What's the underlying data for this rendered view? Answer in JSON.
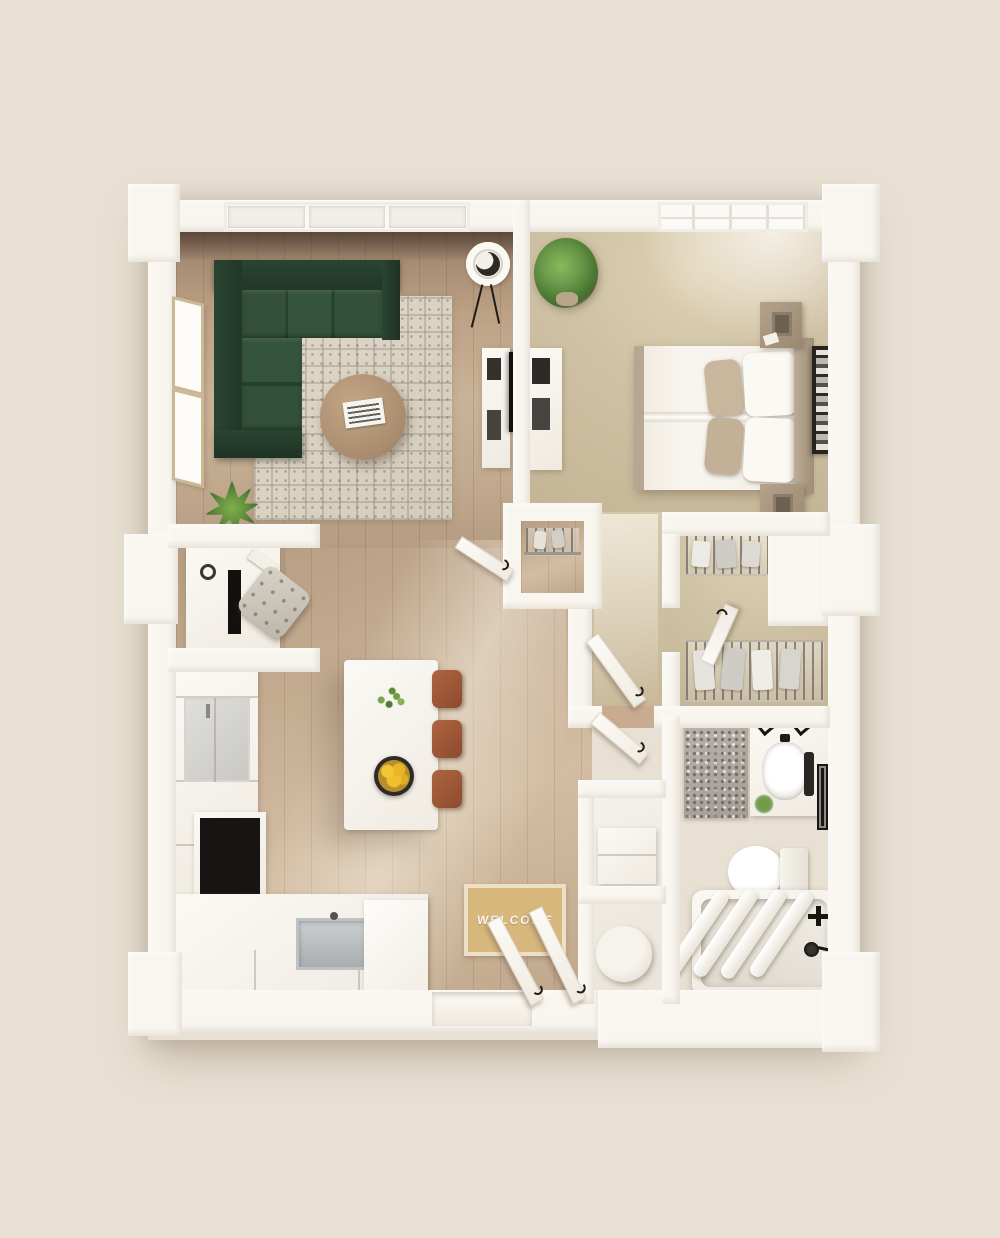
{
  "scene": {
    "title": "3D apartment floor plan, top-down dollhouse view",
    "view": "top-down"
  },
  "entry": {
    "mat_text": "WELCOME"
  },
  "palette": {
    "background": "#e8e1d3",
    "wall": "#f9f6f0",
    "wallShade": "#ece6db",
    "sofaBack": "#24392b",
    "sofaSeat": "#2f4b36",
    "rugBase": "#dcd5c6",
    "rugLine": "#8d8475",
    "tableWood": "#b2937a",
    "stool": "#9c5636",
    "lemon": "#ecba2d",
    "mat": "#d7b77c",
    "matText": "#faf5ea",
    "taupe": "#b2a18c",
    "blackish": "#1d1a17",
    "steel": "#b9bcbe",
    "plantGreen": "#5e8d3c",
    "plantDark": "#3f6b2a",
    "carpet": "#cbbc9e",
    "woodMid": "#b99f86",
    "bathWood": "#9d8069",
    "grayRug": "#b3ada6"
  },
  "rooms": [
    {
      "id": "living-room",
      "furniture": [
        "sectional-sofa",
        "area-rug",
        "coffee-table",
        "magazines",
        "floor-plant",
        "side-table",
        "tv-console",
        "picture-window"
      ]
    },
    {
      "id": "bedroom",
      "furniture": [
        "double-bed",
        "headboard",
        "nightstand-top",
        "nightstand-bottom",
        "table-lamps",
        "wall-art",
        "dresser",
        "potted-plant",
        "grid-window"
      ]
    },
    {
      "id": "kitchen",
      "furniture": [
        "refrigerator",
        "stove-cooktop",
        "counter",
        "sink",
        "pantry-cabinet",
        "island",
        "island-plant",
        "fruit-bowl",
        "bar-stool-1",
        "bar-stool-2",
        "bar-stool-3"
      ]
    },
    {
      "id": "desk-nook",
      "furniture": [
        "desk",
        "laptop",
        "desk-chair"
      ]
    },
    {
      "id": "coat-closet",
      "furniture": [
        "hanging-rod",
        "clothes-hangers"
      ]
    },
    {
      "id": "walk-in-closet",
      "furniture": [
        "wire-shelf-top",
        "wire-shelf-bottom",
        "hanging-clothes"
      ]
    },
    {
      "id": "bathroom",
      "furniture": [
        "vanity",
        "vanity-sink",
        "mirror",
        "toilet",
        "bathtub",
        "towels",
        "bath-rug",
        "towel-bar"
      ]
    },
    {
      "id": "laundry-closet",
      "furniture": [
        "washer",
        "water-heater"
      ]
    },
    {
      "id": "entry",
      "furniture": [
        "welcome-mat",
        "entry-doors"
      ]
    }
  ]
}
